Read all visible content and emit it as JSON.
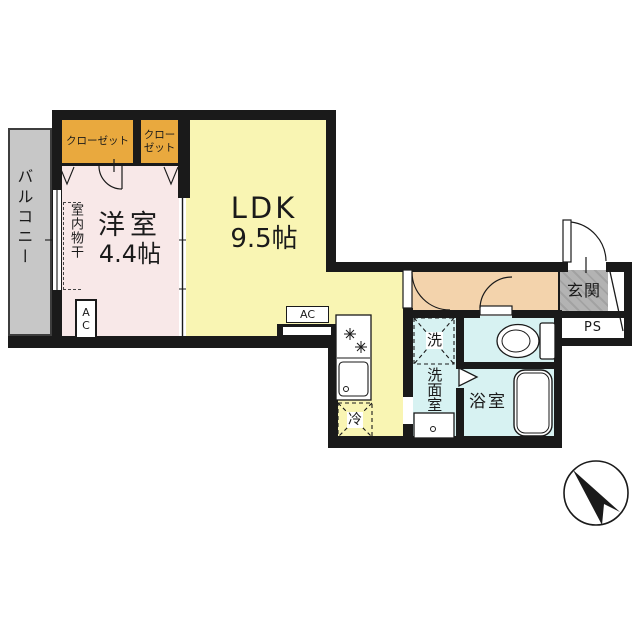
{
  "plan": {
    "balcony": "バルコニー",
    "closet_left": "クローゼット",
    "closet_right_line1": "クロー",
    "closet_right_line2": "ゼット",
    "western_room_name": "洋室",
    "western_room_size": "4.4帖",
    "indoor_drying": "室内物干",
    "room_ac": "AC",
    "ldk_name": "LDK",
    "ldk_size": "9.5帖",
    "ldk_ac": "AC",
    "entrance": "玄関",
    "pipe_space": "PS",
    "washer": "洗",
    "washroom": "洗面室",
    "bathroom": "浴室",
    "refrigerator": "冷"
  },
  "colors": {
    "wall": "#1a1a1a",
    "western_room": "#f8e8e8",
    "ldk": "#f9f5b3",
    "closet": "#e9a93e",
    "hallway": "#f3d3ac",
    "wet_area": "#d7f2f2",
    "entrance": "#b3b3b3",
    "balcony": "#c7c7c7"
  }
}
